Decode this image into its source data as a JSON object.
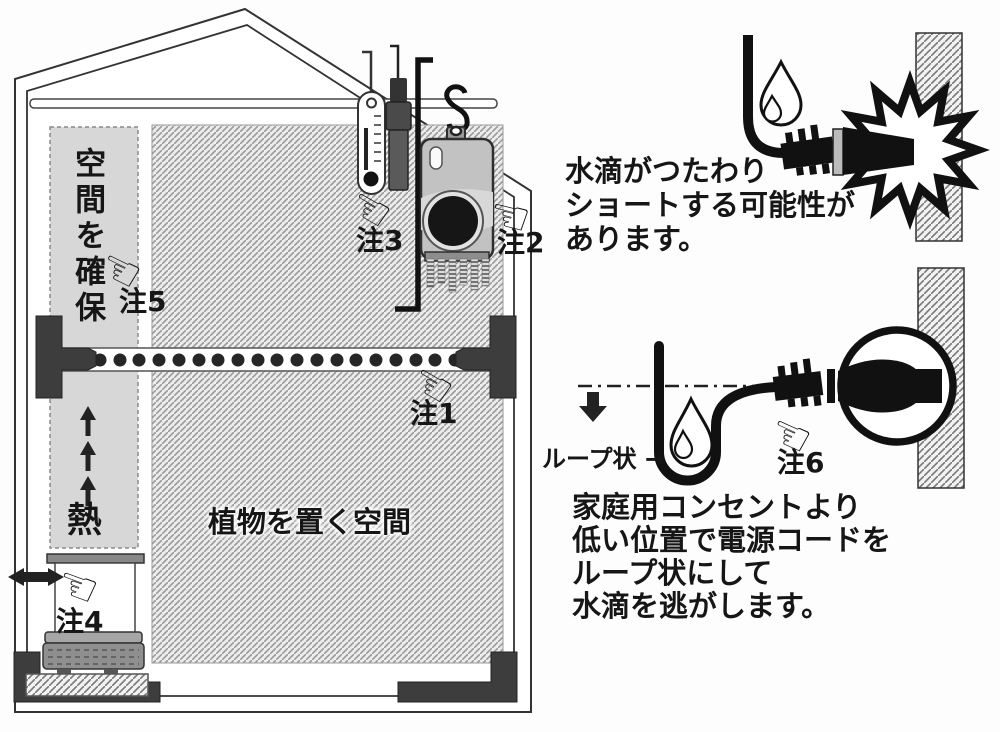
{
  "colors": {
    "ink": "#1a1a1a",
    "column_gray": "#d7d7d7",
    "hatch_gray": "#9a9a9a",
    "bracket_dark": "#3d3d3d"
  },
  "icons": {
    "pointing_hand": "☜"
  },
  "greenhouse": {
    "clearance_label": "空間を確保",
    "heat_label": "熱",
    "plant_area_label": "植物を置く空間",
    "notes": {
      "note1": "注1",
      "note2": "注2",
      "note3": "注3",
      "note4": "注4",
      "note5": "注5"
    }
  },
  "short_circuit_warning": {
    "line1": "水滴がつたわり",
    "line2": "ショートする可能性が",
    "line3": "あります。"
  },
  "drip_loop": {
    "loop_label": "ループ状 →",
    "note6": "注6",
    "line1": "家庭用コンセントより",
    "line2": "低い位置で電源コードを",
    "line3": "ループ状にして",
    "line4": "水滴を逃がします。"
  }
}
